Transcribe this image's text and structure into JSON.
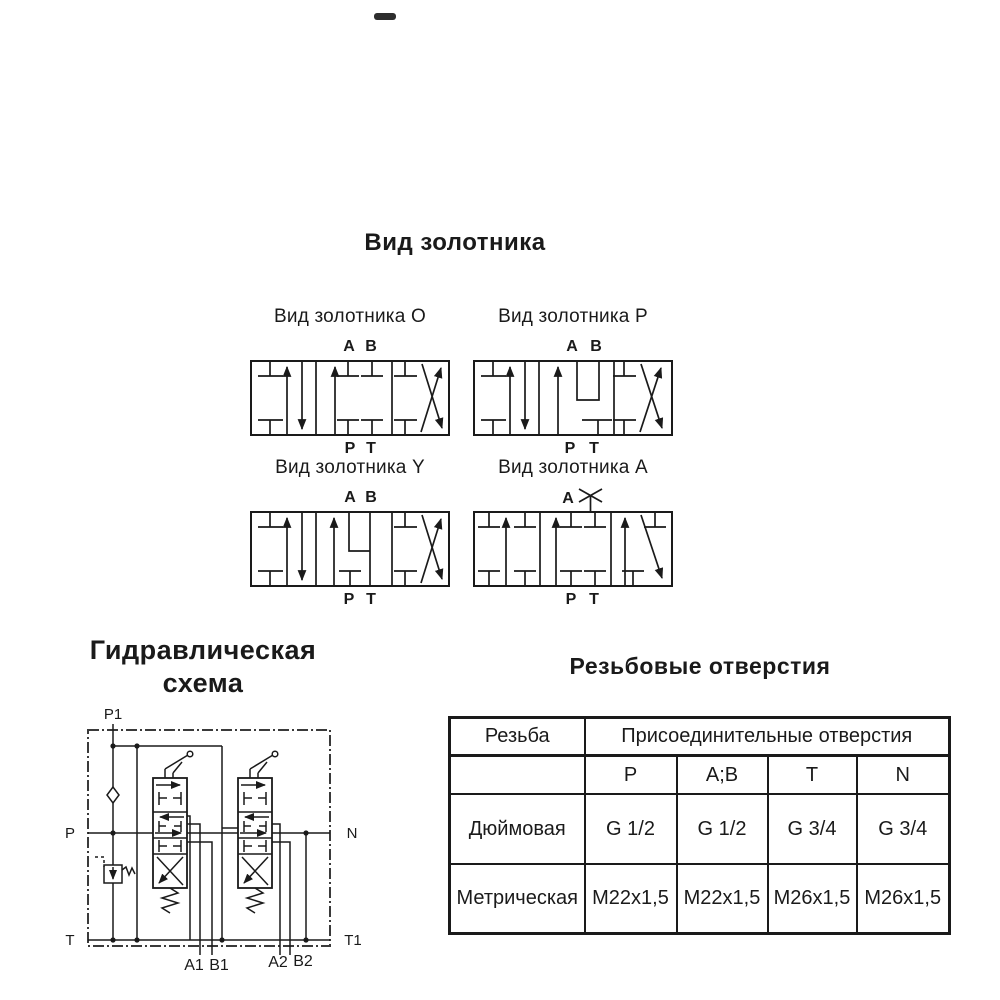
{
  "main_title": "Вид золотника",
  "valves": [
    {
      "id": "O",
      "title": "Вид золотника O",
      "port_a": "A",
      "port_b": "B",
      "port_p": "P",
      "port_t": "T"
    },
    {
      "id": "P",
      "title": "Вид золотника P",
      "port_a": "A",
      "port_b": "B",
      "port_p": "P",
      "port_t": "T"
    },
    {
      "id": "Y",
      "title": "Вид золотника Y",
      "port_a": "A",
      "port_b": "B",
      "port_p": "P",
      "port_t": "T"
    },
    {
      "id": "A",
      "title": "Вид золотника A",
      "port_a": "A",
      "port_b_plugged": true,
      "port_p": "P",
      "port_t": "T"
    }
  ],
  "hydraulic": {
    "title_line1": "Гидравлическая",
    "title_line2": "схема",
    "labels": {
      "p1": "P1",
      "p": "P",
      "t": "T",
      "n": "N",
      "t1": "T1",
      "a1": "A1",
      "b1": "B1",
      "a2": "A2",
      "b2": "B2"
    }
  },
  "table": {
    "title": "Резьбовые отверстия",
    "col_header": "Резьба",
    "span_header": "Присоединительные отверстия",
    "columns": [
      "P",
      "A;B",
      "T",
      "N"
    ],
    "rows": [
      {
        "name": "Дюймовая",
        "values": [
          "G 1/2",
          "G 1/2",
          "G 3/4",
          "G 3/4"
        ]
      },
      {
        "name": "Метрическая",
        "values": [
          "M22x1,5",
          "M22x1,5",
          "M26x1,5",
          "M26x1,5"
        ]
      }
    ]
  },
  "colors": {
    "ink": "#1a1a1a",
    "background": "#ffffff"
  }
}
